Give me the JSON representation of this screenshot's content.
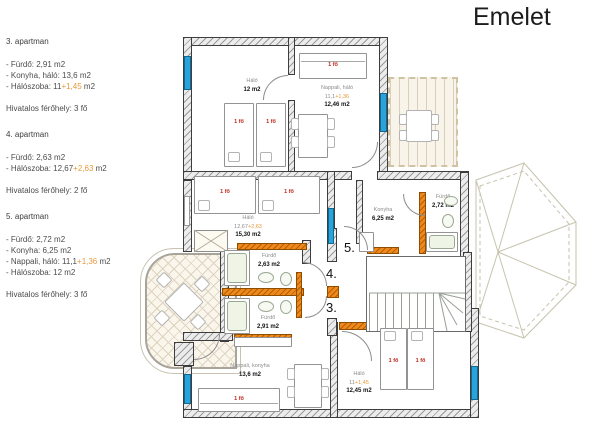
{
  "title": "Emelet",
  "accent_colors": {
    "orange": "#E8821E",
    "window_blue": "#29A3DC",
    "occupant_red": "#C0281E"
  },
  "info_panel": {
    "apartments": [
      {
        "heading": "3. apartman",
        "lines": [
          {
            "text": "- Fürdő: 2,91 m2",
            "extra": "",
            "suffix": ""
          },
          {
            "text": "- Konyha, háló: 13,6 m2",
            "extra": "",
            "suffix": ""
          },
          {
            "text": "- Hálószoba: 11",
            "extra": "+1,45",
            "suffix": " m2"
          }
        ],
        "capacity": "Hivatalos férőhely: 3 fő"
      },
      {
        "heading": "4. apartman",
        "lines": [
          {
            "text": "- Fürdő: 2,63 m2",
            "extra": "",
            "suffix": ""
          },
          {
            "text": "- Hálószoba: 12,67",
            "extra": "+2,63",
            "suffix": " m2"
          }
        ],
        "capacity": "Hivatalos férőhely: 2 fő"
      },
      {
        "heading": "5. apartman",
        "lines": [
          {
            "text": "- Fürdő: 2,72 m2",
            "extra": "",
            "suffix": ""
          },
          {
            "text": "- Konyha: 6,25 m2",
            "extra": "",
            "suffix": ""
          },
          {
            "text": "- Nappali, háló: 11,1",
            "extra": "+1,36",
            "suffix": " m2"
          },
          {
            "text": "- Hálószoba: 12 m2",
            "extra": "",
            "suffix": ""
          }
        ],
        "capacity": "Hivatalos férőhely: 3 fő"
      }
    ]
  },
  "plan": {
    "occupant_label": "1 fő",
    "entries": {
      "e5": "5.",
      "e4": "4.",
      "e3": "3."
    },
    "rooms": {
      "halo_top": {
        "name": "Háló",
        "area": "12 m2"
      },
      "nappali_halo": {
        "name": "Nappali, háló",
        "calc": "11,1",
        "calc_extra": "+1,36",
        "area": "12,46 m2"
      },
      "halo_mid": {
        "name": "Háló",
        "calc": "12,67",
        "calc_extra": "+2,63",
        "area": "15,30 m2"
      },
      "furdo_4": {
        "name": "Fürdő",
        "area": "2,63 m2"
      },
      "furdo_3": {
        "name": "Fürdő",
        "area": "2,91 m2"
      },
      "konyha_5": {
        "name": "Konyha",
        "area": "6,25 m2"
      },
      "furdo_5": {
        "name": "Fürdő",
        "area": "2,72 m2"
      },
      "nappali_konyha": {
        "name": "Nappali, konyha",
        "area": "13,6 m2"
      },
      "halo_bottom": {
        "name": "Háló",
        "calc": "11",
        "calc_extra": "+1,45",
        "area": "12,45 m2"
      }
    }
  }
}
